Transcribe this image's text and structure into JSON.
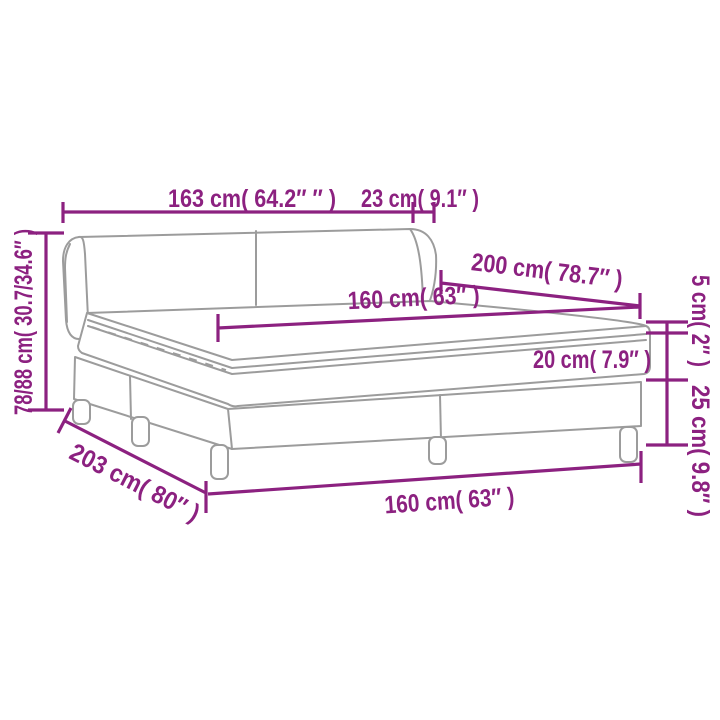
{
  "diagram": {
    "kind": "product-dimension-diagram",
    "subject": "box spring bed with headboard, pillow-top mattress and legs",
    "background_color": "#ffffff",
    "dimension_color": "#8c2180",
    "artwork_line_color": "#9c9c9c"
  },
  "labels": {
    "headboard_width": "163 cm( 64.2″ ″ )",
    "headboard_side_depth": "23 cm( 9.1″ )",
    "bed_length": "200 cm( 78.7″ )",
    "mattress_width": "160 cm( 63″ )",
    "topper_thickness": "5 cm( 2″ )",
    "mattress_thickness": "20 cm( 7.9″ )",
    "base_height": "25 cm( 9.8″ )",
    "overall_height": "78/88 cm( 30.7/34.6″ )",
    "base_length": "203 cm( 80″ )",
    "base_width": "160 cm( 63″ )"
  }
}
